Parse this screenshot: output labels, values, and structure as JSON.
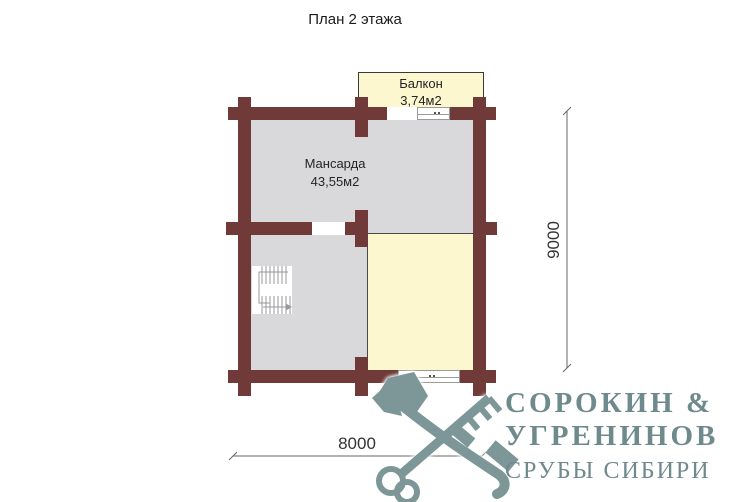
{
  "title": "План 2 этажа",
  "plan": {
    "mansarda": {
      "name": "Мансарда",
      "area": "43,55м2"
    },
    "balcony": {
      "name": "Балкон",
      "area": "3,74м2"
    }
  },
  "dimensions": {
    "horizontal": "8000",
    "vertical": "9000"
  },
  "logo": {
    "company_line1": "СОРОКИН &",
    "company_line2": "УГРЕНИНОВ",
    "tagline": "СРУБЫ СИБИРИ"
  },
  "colors": {
    "wall": "#6f3a38",
    "room_gray": "#d9d9db",
    "room_yellow": "#fcf7cf",
    "logo_graphic": "#7d9697",
    "logo_text": "#6f8a8d"
  }
}
